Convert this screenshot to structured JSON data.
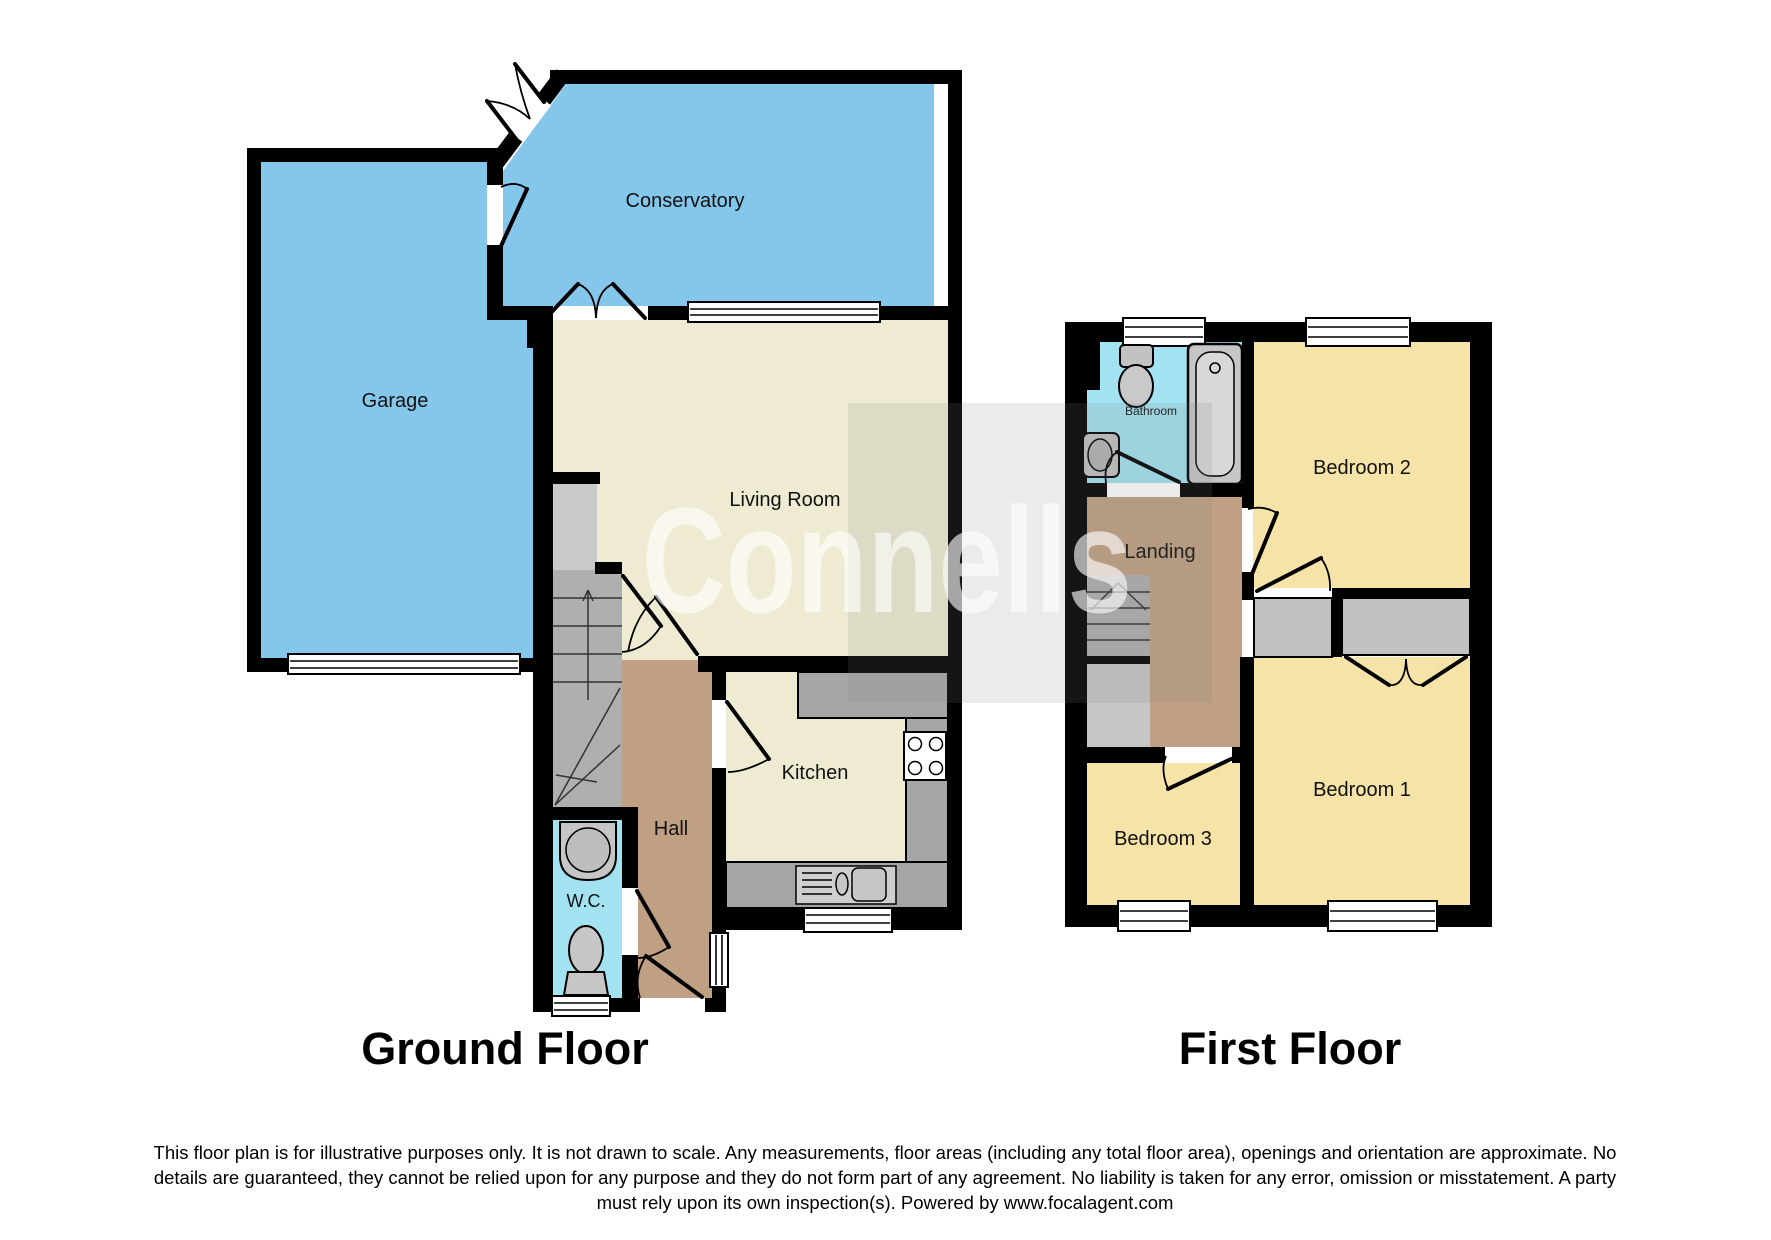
{
  "watermark": {
    "text": "Connells"
  },
  "ground_floor": {
    "title": "Ground Floor",
    "rooms": {
      "garage": "Garage",
      "conservatory": "Conservatory",
      "living_room": "Living Room",
      "kitchen": "Kitchen",
      "hall": "Hall",
      "wc": "W.C."
    }
  },
  "first_floor": {
    "title": "First Floor",
    "rooms": {
      "bathroom": "Bathroom",
      "landing": "Landing",
      "bedroom1": "Bedroom 1",
      "bedroom2": "Bedroom 2",
      "bedroom3": "Bedroom 3"
    }
  },
  "disclaimer": {
    "line1": "This floor plan is for illustrative purposes only. It is not drawn to scale. Any measurements, floor areas (including any total floor area), openings and orientation are approximate. No",
    "line2": "details are guaranteed, they cannot be relied upon for any purpose and they do not form part of any agreement. No liability is taken for any error, omission or misstatement. A party",
    "line3": "must rely upon its own inspection(s). Powered by www.focalagent.com"
  },
  "colors": {
    "room_blue": "#85C6EB",
    "room_cyan": "#A3E2F1",
    "room_cream": "#EFEBD3",
    "room_yellow": "#F5E3A7",
    "hall_brown": "#C0A083",
    "stairs_gray": "#AFAFAF",
    "counter_gray": "#A6A6A6",
    "wall_black": "#000000"
  }
}
